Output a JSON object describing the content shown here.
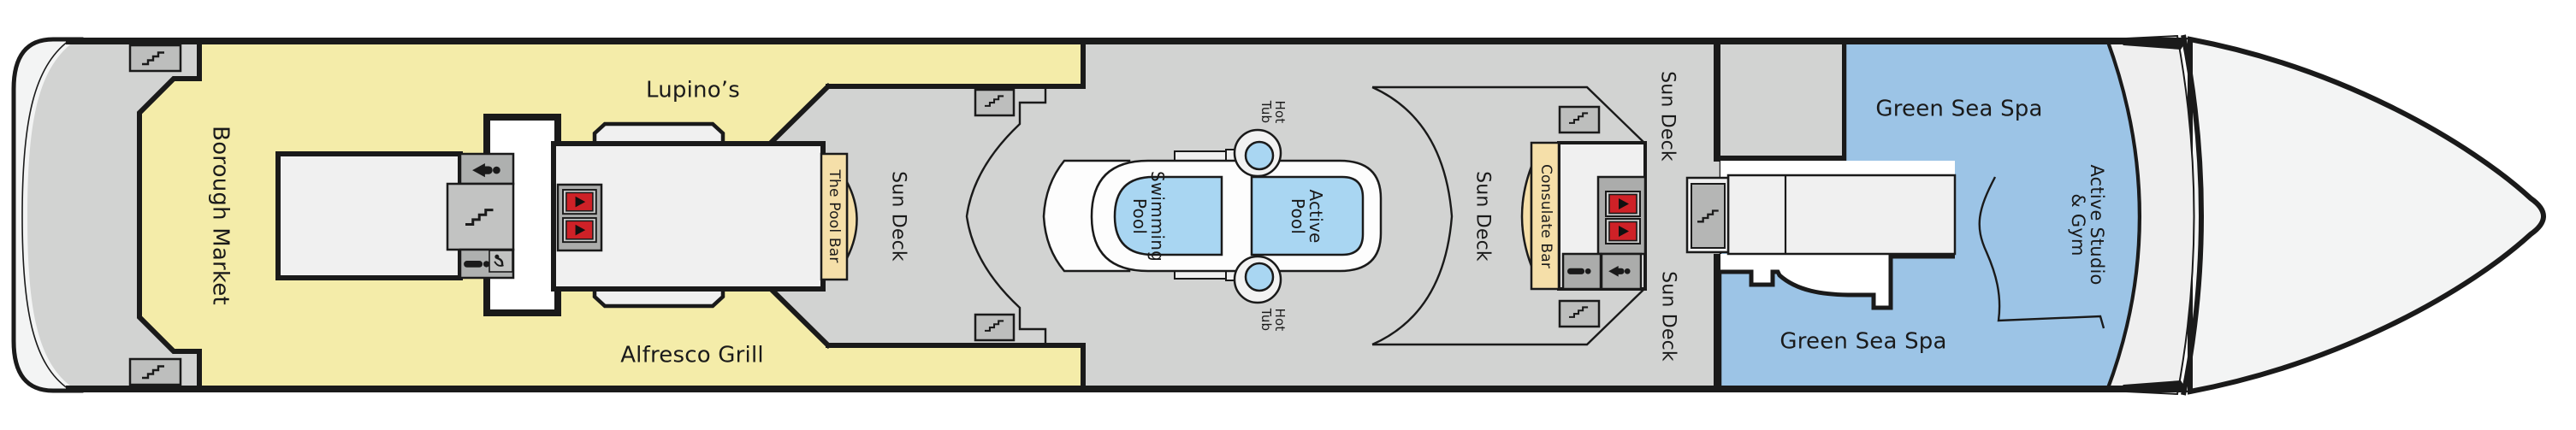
{
  "labels": {
    "borough_market": "Borough Market",
    "lupinos": "Lupino’s",
    "alfresco_grill": "Alfresco Grill",
    "pool_bar": "The Pool Bar",
    "sun_deck_aft": "Sun Deck",
    "sun_deck_mid": "Sun Deck",
    "sun_deck_fwd_top": "Sun Deck",
    "sun_deck_fwd_bottom": "Sun Deck",
    "consulate_bar": "Consulate Bar",
    "green_sea_spa_top": "Green Sea Spa",
    "green_sea_spa_bottom": "Green Sea Spa",
    "swimming_pool": [
      "Swimming",
      "Pool"
    ],
    "active_pool": [
      "Active",
      "Pool"
    ],
    "hot_tub_top": [
      "Hot",
      "Tub"
    ],
    "hot_tub_bottom": [
      "Hot",
      "Tub"
    ],
    "active_studio_gym": [
      "Active Studio",
      "& Gym"
    ]
  },
  "icons": {
    "stairs": "stairs-icon",
    "elevator": "elevator-icon",
    "mens_restroom": "mens-restroom-icon",
    "womens_restroom": "womens-restroom-icon",
    "accessible": "accessible-icon"
  },
  "colors": {
    "venue_yellow": "#F4ECA9",
    "deck_gray": "#D2D3D2",
    "block_gray": "#AEB0AF",
    "stair_gray": "#C2C3C2",
    "room_white": "#F0F0F0",
    "corridor_white": "#FFFFFF",
    "pool_blue": "#A9D6F2",
    "spa_blue": "#9CC4E6",
    "bar_tan": "#F5DFA9",
    "elevator_red": "#CE2127",
    "outline_black": "#1A1A1A",
    "hull_white": "#F3F4F4"
  }
}
